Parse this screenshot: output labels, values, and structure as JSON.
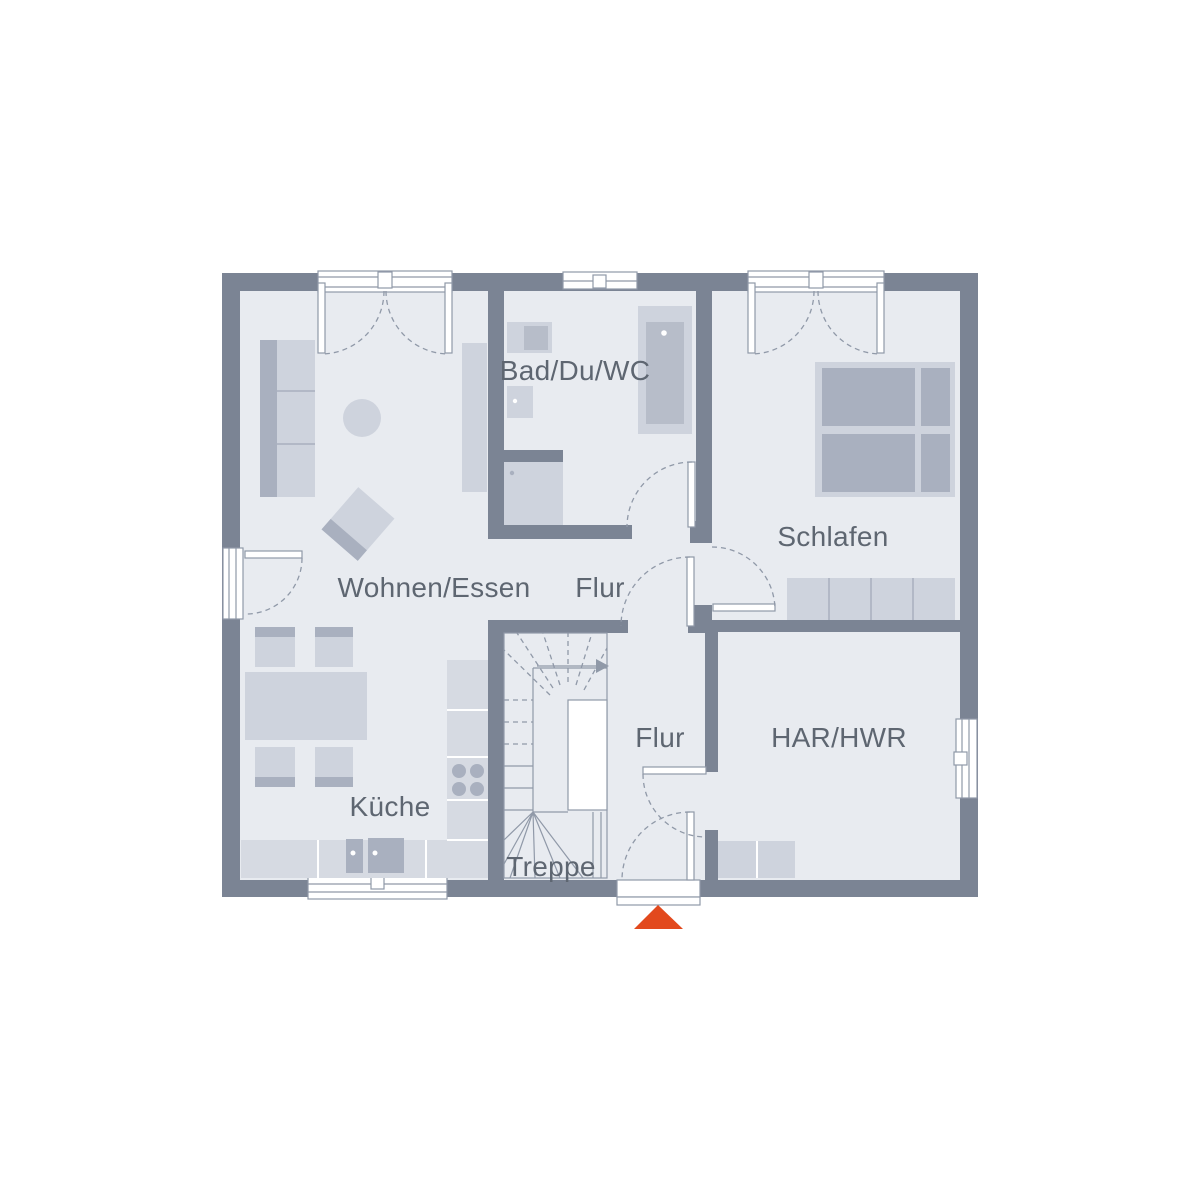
{
  "title": "Erdgeschoss Grundriss",
  "rooms": {
    "living": {
      "label": "Wohnen/Essen"
    },
    "kitchen": {
      "label": "Küche"
    },
    "bath": {
      "label": "Bad/Du/WC"
    },
    "bedroom": {
      "label": "Schlafen"
    },
    "upper_hall": {
      "label": "Flur"
    },
    "lower_hall": {
      "label": "Flur"
    },
    "stairs": {
      "label": "Treppe"
    },
    "utility": {
      "label": "HAR/HWR"
    }
  },
  "icons": {
    "entrance_marker": "filled-triangle-up"
  },
  "palette": {
    "wall": "#7b8494",
    "floor": "#e8ebf0",
    "furn_light": "#ced3dd",
    "furn_mid": "#b7bdc9",
    "furn_dark": "#a9b0bf",
    "counter": "#d6dae2",
    "line": "#9099a8",
    "text": "#5e6671",
    "accent": "#e2491d",
    "background": "#ffffff"
  }
}
